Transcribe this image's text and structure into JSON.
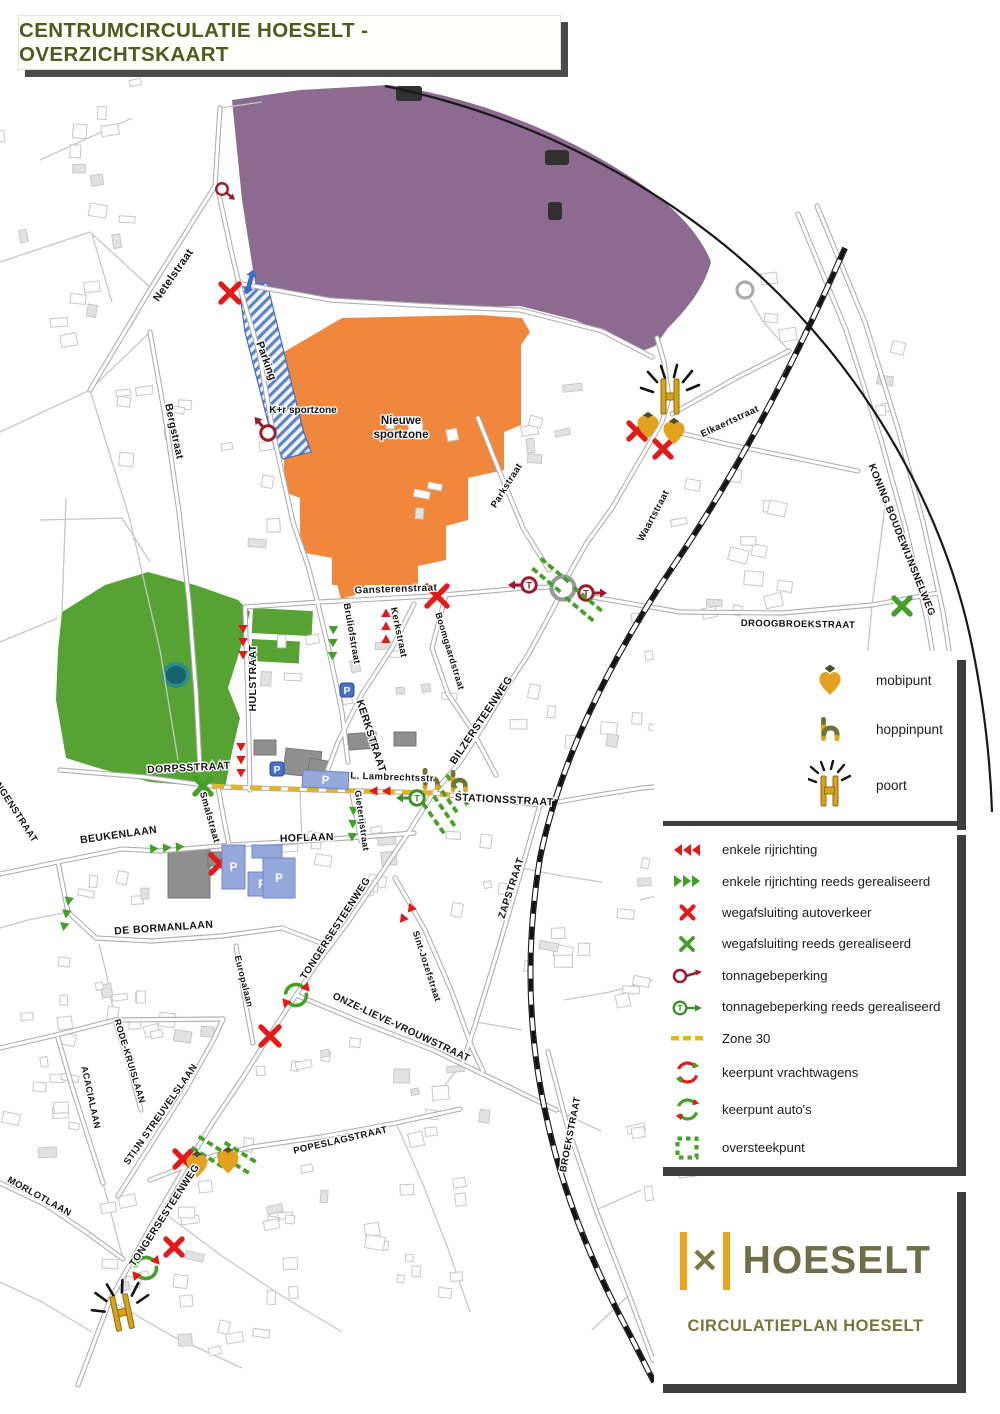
{
  "title": {
    "text": "CENTRUMCIRCULATIE HOESELT - OVERZICHTSKAART"
  },
  "palette": {
    "title_green": "#4f5a1e",
    "olive": "#6b7435",
    "gold": "#e2a21f",
    "purple": "#8d6b91",
    "orange": "#f1873d",
    "park_green": "#56a334",
    "pond_teal": "#17616b",
    "red": "#e11a1a",
    "green_symbol": "#44a028",
    "maroon": "#9b1c2e",
    "parking_blue": "#94a8dc",
    "parking_icon_blue": "#4a71c8",
    "zone30_yellow": "#e3b229",
    "hatch_blue": "#5b84c9"
  },
  "icons": {
    "p_letter": "P",
    "t_letter": "T"
  },
  "legend_points": {
    "items": [
      {
        "icon": "mobipunt-icon",
        "label": "mobipunt"
      },
      {
        "icon": "hoppinpunt-icon",
        "label": "hoppinpunt"
      },
      {
        "icon": "poort-icon",
        "label": "poort"
      }
    ]
  },
  "legend_symbols": {
    "items": [
      {
        "icon": "red-arrows-icon",
        "label": "enkele rijrichting"
      },
      {
        "icon": "green-arrows-icon",
        "label": "enkele rijrichting reeds gerealiseerd"
      },
      {
        "icon": "red-x-icon",
        "label": "wegafsluiting autoverkeer"
      },
      {
        "icon": "green-x-icon",
        "label": "wegafsluiting reeds gerealiseerd"
      },
      {
        "icon": "tonnage-icon",
        "label": "tonnagebeperking"
      },
      {
        "icon": "tonnage-done-icon",
        "label": "tonnagebeperking reeds gerealiseerd"
      },
      {
        "icon": "zone30-icon",
        "label": "Zone 30"
      },
      {
        "icon": "keerpunt-trucks-icon",
        "label": "keerpunt vrachtwagens"
      },
      {
        "icon": "keerpunt-cars-icon",
        "label": "keerpunt auto's"
      },
      {
        "icon": "oversteekpunt-icon",
        "label": "oversteekpunt"
      }
    ]
  },
  "logo": {
    "name": "HOESELT",
    "subtitle": "CIRCULATIEPLAN HOESELT"
  },
  "map": {
    "zone_labels": [
      {
        "text": "Parking",
        "x": 263,
        "y": 362,
        "r": 70,
        "s": 11
      },
      {
        "text": "K+r sportzone",
        "x": 303,
        "y": 413,
        "r": 0,
        "s": 10
      },
      {
        "text": "Nieuwe",
        "x": 401,
        "y": 424,
        "r": 0,
        "s": 11.5
      },
      {
        "text": "sportzone",
        "x": 401,
        "y": 438,
        "r": 0,
        "s": 11.5
      }
    ],
    "street_labels": [
      {
        "text": "Netelstraat",
        "x": 176,
        "y": 277,
        "r": -55,
        "s": 11
      },
      {
        "text": "Bergstraat",
        "x": 171,
        "y": 432,
        "r": 78,
        "s": 10.5
      },
      {
        "text": "Gansterenstraat",
        "x": 396,
        "y": 592,
        "r": -2,
        "s": 10
      },
      {
        "text": "Bruliofstraat",
        "x": 349,
        "y": 634,
        "r": 80,
        "s": 9.5
      },
      {
        "text": "Kerkstraat",
        "x": 396,
        "y": 633,
        "r": 78,
        "s": 9.5
      },
      {
        "text": "Boomgaardstraat",
        "x": 447,
        "y": 652,
        "r": 73,
        "s": 9
      },
      {
        "text": "HULSTRAAT",
        "x": 256,
        "y": 678,
        "r": -90,
        "s": 10.5
      },
      {
        "text": "KERKSTRAAT",
        "x": 368,
        "y": 737,
        "r": 72,
        "s": 10.5
      },
      {
        "text": "BILZERSTEENWEG",
        "x": 484,
        "y": 722,
        "r": -56,
        "s": 10.5
      },
      {
        "text": "Parkstraat",
        "x": 509,
        "y": 487,
        "r": -58,
        "s": 9.5
      },
      {
        "text": "Waartstraat",
        "x": 656,
        "y": 517,
        "r": -62,
        "s": 9.5
      },
      {
        "text": "Elkaertstraat",
        "x": 731,
        "y": 424,
        "r": -25,
        "s": 9.5
      },
      {
        "text": "DROOGBROEKSTRAAT",
        "x": 798,
        "y": 627,
        "r": 1,
        "s": 9.5
      },
      {
        "text": "KONING BOUDEWIJNSNELWEG",
        "x": 899,
        "y": 541,
        "r": 68,
        "s": 10
      },
      {
        "text": "DORPSSTRAAT",
        "x": 189,
        "y": 771,
        "r": -3,
        "s": 10.5
      },
      {
        "text": "Smalstraat",
        "x": 207,
        "y": 818,
        "r": 74,
        "s": 9.5
      },
      {
        "text": "L. Lambrechtsstr",
        "x": 392,
        "y": 780,
        "r": 2,
        "s": 9.5
      },
      {
        "text": "STATIONSSTRAAT",
        "x": 504,
        "y": 803,
        "r": 3,
        "s": 10.5
      },
      {
        "text": "Gieterijstraat",
        "x": 359,
        "y": 821,
        "r": 82,
        "s": 9
      },
      {
        "text": "HOFLAAN",
        "x": 307,
        "y": 841,
        "r": -2,
        "s": 10.5
      },
      {
        "text": "BEUKENLAAN",
        "x": 119,
        "y": 838,
        "r": -8,
        "s": 10.5
      },
      {
        "text": "DE BORMANLAAN",
        "x": 164,
        "y": 931,
        "r": -4,
        "s": 10.5
      },
      {
        "text": "ZAPSTRAAT",
        "x": 514,
        "y": 889,
        "r": -72,
        "s": 10
      },
      {
        "text": "Sint-Jozefstraat",
        "x": 424,
        "y": 967,
        "r": 72,
        "s": 9
      },
      {
        "text": "TONGERSESTEENWEG",
        "x": 338,
        "y": 930,
        "r": -57,
        "s": 10
      },
      {
        "text": "ONZE-LIEVE-VROUWSTRAAT",
        "x": 400,
        "y": 1030,
        "r": 25,
        "s": 10
      },
      {
        "text": "Europalaan",
        "x": 241,
        "y": 982,
        "r": 76,
        "s": 9
      },
      {
        "text": "RODE-KRUISLAAN",
        "x": 127,
        "y": 1062,
        "r": 73,
        "s": 9
      },
      {
        "text": "ACACIALAAN",
        "x": 88,
        "y": 1098,
        "r": 78,
        "s": 9
      },
      {
        "text": "STIJN STREUVELSLAAN",
        "x": 163,
        "y": 1116,
        "r": -55,
        "s": 9.5
      },
      {
        "text": "MORLOTLAAN",
        "x": 38,
        "y": 1199,
        "r": 29,
        "s": 9.5
      },
      {
        "text": "TONGERSESTEENWEG",
        "x": 167,
        "y": 1217,
        "r": -57,
        "s": 10
      },
      {
        "text": "POPESLAGSTRAAT",
        "x": 341,
        "y": 1143,
        "r": -13,
        "s": 9.5
      },
      {
        "text": "BROEKSTRAAT",
        "x": 573,
        "y": 1135,
        "r": -79,
        "s": 9.5
      },
      {
        "text": "NGENSTRAAT",
        "x": 14,
        "y": 814,
        "r": 57,
        "s": 9.5
      }
    ]
  }
}
